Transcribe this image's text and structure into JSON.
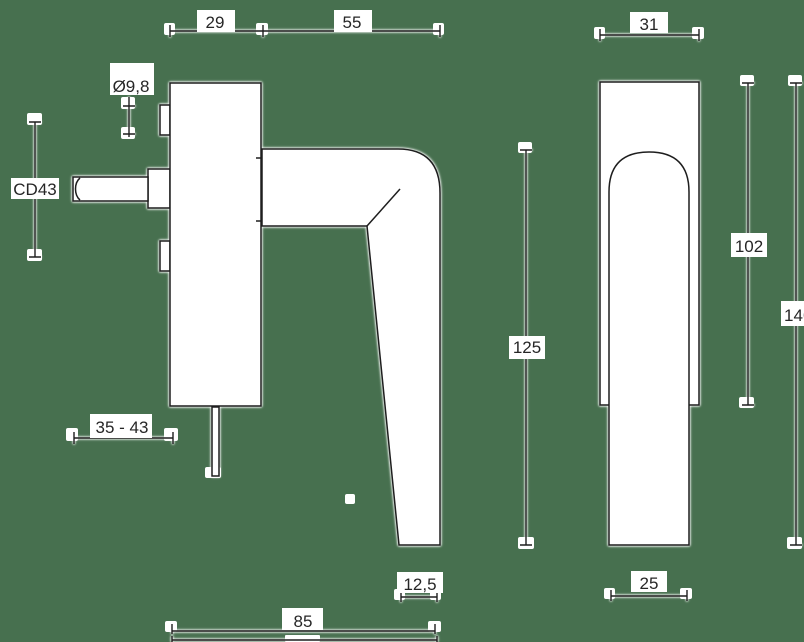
{
  "colors": {
    "background": "#47704f",
    "line": "#1e1e1e",
    "text": "#262626",
    "shape_fill": "#ffffff",
    "halo": "#ffffff"
  },
  "dimensions": {
    "plate_depth": "29",
    "lever_reach": "55",
    "spindle_diameter": "Ø9,8",
    "center_distance": "CD43",
    "spindle_length_range": "35 - 43",
    "handle_height": "125",
    "grip_bottom_depth": "12,5",
    "total_depth": "85",
    "plate_width": "31",
    "plate_height": "102",
    "total_height": "146",
    "grip_width": "25"
  }
}
